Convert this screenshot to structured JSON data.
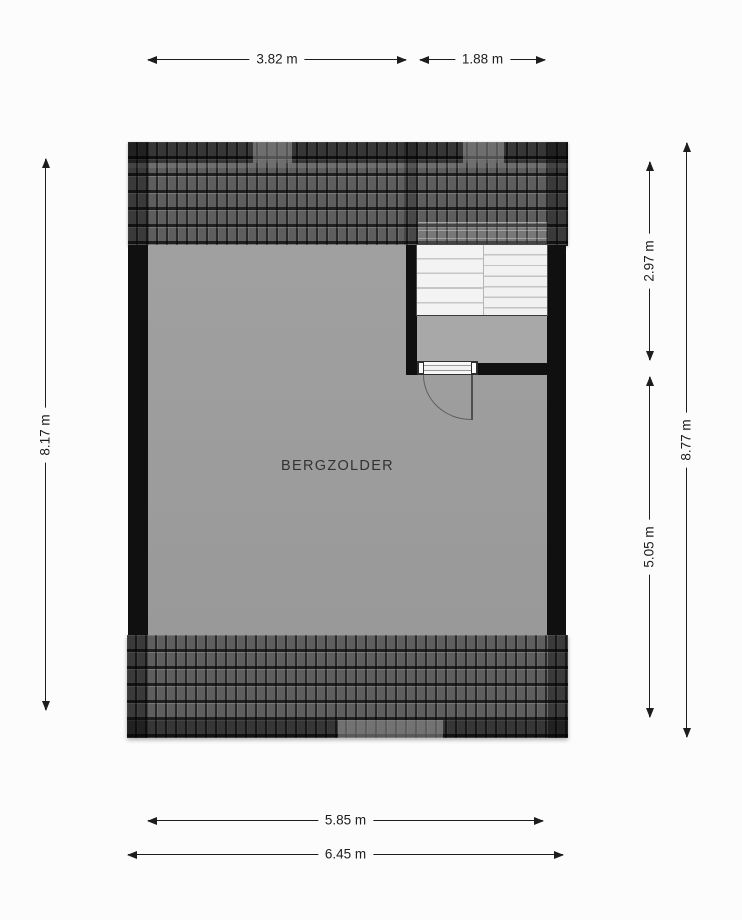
{
  "room": {
    "label": "BERGZOLDER"
  },
  "dimensions": {
    "top_width_room": "3.82 m",
    "top_width_stairs": "1.88 m",
    "left_height": "8.17 m",
    "right_stairwell_depth": "2.97 m",
    "right_room_depth": "5.05 m",
    "right_total_height": "8.77 m",
    "bottom_width_inner": "5.85 m",
    "bottom_width_outer": "6.45 m"
  },
  "colors": {
    "background": "#fcfcfc",
    "floor": "#9e9e9e",
    "wall": "#101010",
    "roof_tile": "#5e5e5e",
    "stairs": "#f2f2f2",
    "dimension_line": "#1d1d1d"
  }
}
